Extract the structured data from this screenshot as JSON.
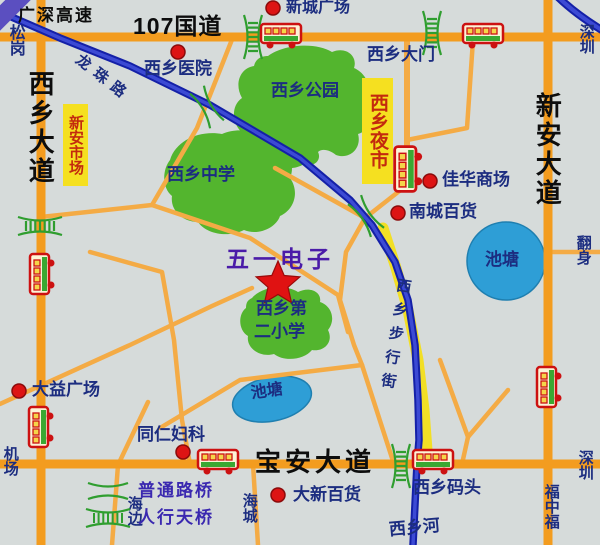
{
  "map_title": "西乡区域地图",
  "roads": {
    "g107": "107国道",
    "guangshen": "广深高速",
    "xixiang_ave": "西乡大道",
    "xinan_ave": "新安大道",
    "baoan_ave": "宝安大道",
    "longzhu_rd": "龙珠路",
    "walking_street": "西乡步行街",
    "xixiang_river": "西乡河"
  },
  "pois": {
    "xincheng_plaza": "新城广场",
    "hospital": "西乡医院",
    "gate": "西乡大门",
    "park": "西乡公园",
    "middle_school": "西乡中学",
    "wuyi_dianzi": "五一电子",
    "primary_school_line1": "西乡第",
    "primary_school_line2": "二小学",
    "jiahua_mall": "佳华商场",
    "nancheng_store": "南城百货",
    "dayi_plaza": "大益广场",
    "tongren_clinic": "同仁妇科",
    "daxin_store": "大新百货",
    "wharf": "西乡码头",
    "pond1": "池塘",
    "pond2": "池塘",
    "xinan_market": "新安市场",
    "night_market": "西乡夜市"
  },
  "edge_labels": {
    "songgang": "松岗",
    "shenzhen_top": "深圳",
    "shenzhen_bottom": "深圳",
    "airport": "机场",
    "haibian": "海边",
    "haicheng": "海城",
    "fanshen": "翻身",
    "fuzhongfu": "福中福"
  },
  "legend": {
    "ordinary_bridge": "普通路桥",
    "pedestrian_overpass": "人行天桥"
  },
  "colors": {
    "background": "#d6dbda",
    "road_major": "#f39c1f",
    "road_minor": "#f4ab45",
    "road_yellow": "#f2df25",
    "road_blue_outline": "#1420a8",
    "road_blue_core": "#3c4ad4",
    "green_area": "#53b52e",
    "pond_blue": "#2e9ed6",
    "marker_red": "#dd1414",
    "label_navy": "#1c2d80",
    "label_purple": "#4a1ba8",
    "market_yellow": "#f5e020",
    "market_text_red": "#c32a0e",
    "legend_text": "#3a28b0",
    "bridge_green": "#2f9e2f"
  }
}
